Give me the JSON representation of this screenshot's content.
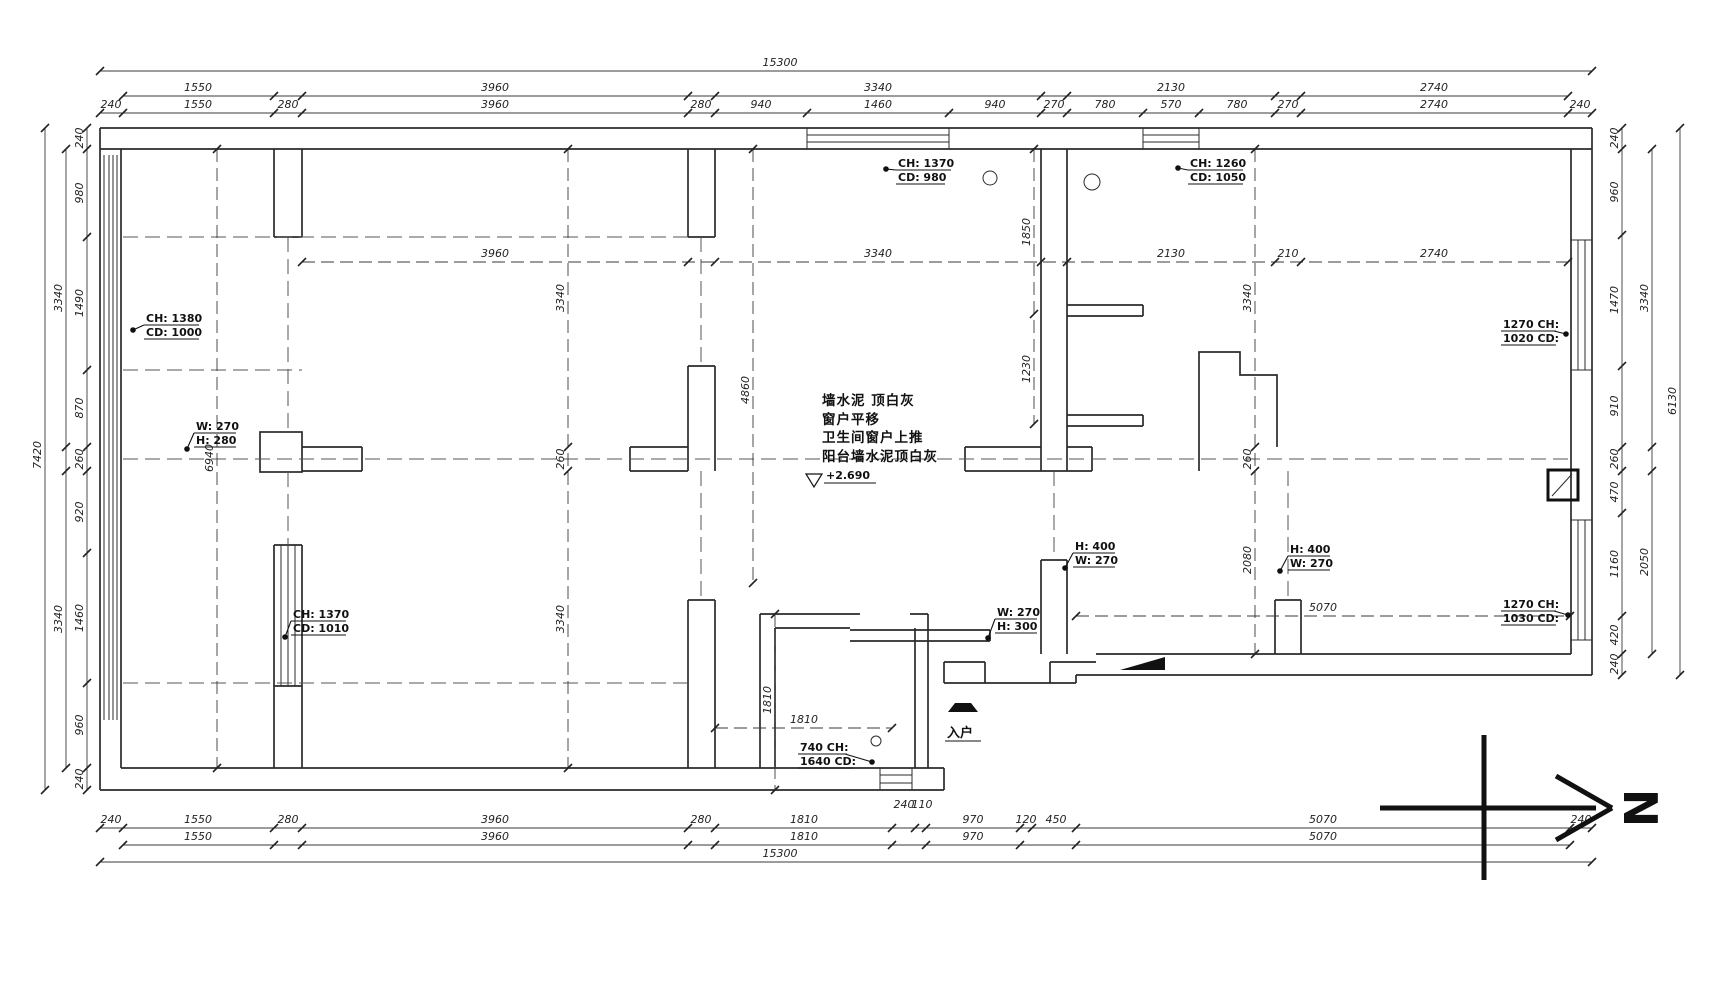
{
  "title": "floor-plan-drawing",
  "colors": {
    "line": "#2b2b2b",
    "dim": "#3a3a3a",
    "accent": "#111111"
  },
  "center_note": {
    "l1": "墙水泥 顶白灰",
    "l2": "窗户平移",
    "l3": "卫生间窗户上推",
    "l4": "阳台墙水泥顶白灰",
    "level": "+2.690"
  },
  "entrance_label": "入户",
  "north_label": "N",
  "leaders": [
    {
      "lines": [
        "CH: 1370",
        "CD: 980"
      ],
      "x": 898,
      "y": 157,
      "dot": [
        886,
        169
      ]
    },
    {
      "lines": [
        "CH: 1260",
        "CD: 1050"
      ],
      "x": 1190,
      "y": 157,
      "dot": [
        1178,
        168
      ]
    },
    {
      "lines": [
        "CH: 1380",
        "CD: 1000"
      ],
      "x": 146,
      "y": 312,
      "dot": [
        133,
        330
      ]
    },
    {
      "lines": [
        "W: 270",
        "H: 280"
      ],
      "x": 196,
      "y": 420,
      "dot": [
        187,
        449
      ]
    },
    {
      "lines": [
        "CH: 1370",
        "CD: 1010"
      ],
      "x": 293,
      "y": 608,
      "dot": [
        285,
        637
      ]
    },
    {
      "lines": [
        "H: 400",
        "W: 270"
      ],
      "x": 1075,
      "y": 540,
      "dot": [
        1065,
        568
      ]
    },
    {
      "lines": [
        "H: 400",
        "W: 270"
      ],
      "x": 1290,
      "y": 543,
      "dot": [
        1280,
        571
      ]
    },
    {
      "lines": [
        "W: 270",
        "H: 300"
      ],
      "x": 997,
      "y": 606,
      "dot": [
        988,
        638
      ]
    },
    {
      "lines": [
        "1270 CH:",
        "1020 CD:"
      ],
      "x": 1503,
      "y": 318,
      "dot": [
        1566,
        334
      ]
    },
    {
      "lines": [
        "1270 CH:",
        "1030 CD:"
      ],
      "x": 1503,
      "y": 598,
      "dot": [
        1568,
        615
      ]
    },
    {
      "lines": [
        "740 CH:",
        "1640 CD:"
      ],
      "x": 800,
      "y": 741,
      "dot": [
        872,
        762
      ]
    }
  ],
  "dim_strips": [
    {
      "name": "top-overall",
      "o": "h",
      "c": 71,
      "a": 100,
      "b": 1592,
      "ticks": [
        100,
        1592
      ],
      "labels": [
        {
          "t": "15300",
          "p": 780
        }
      ]
    },
    {
      "name": "top-sub",
      "o": "h",
      "c": 96,
      "a": 123,
      "b": 1568,
      "ticks": [
        123,
        274,
        302,
        688,
        715,
        1041,
        1067,
        1275,
        1301,
        1568
      ],
      "labels": [
        {
          "t": "1550",
          "p": 198
        },
        {
          "t": "3960",
          "p": 495
        },
        {
          "t": "3340",
          "p": 878
        },
        {
          "t": "2130",
          "p": 1171
        },
        {
          "t": "2740",
          "p": 1434
        }
      ]
    },
    {
      "name": "top-detail",
      "o": "h",
      "c": 113,
      "a": 100,
      "b": 1592,
      "ticks": [
        100,
        123,
        274,
        302,
        688,
        715,
        807,
        949,
        1041,
        1067,
        1143,
        1199,
        1275,
        1301,
        1568,
        1592
      ],
      "labels": [
        {
          "t": "240",
          "p": 111
        },
        {
          "t": "1550",
          "p": 198
        },
        {
          "t": "280",
          "p": 288
        },
        {
          "t": "3960",
          "p": 495
        },
        {
          "t": "280",
          "p": 701
        },
        {
          "t": "940",
          "p": 761
        },
        {
          "t": "1460",
          "p": 878
        },
        {
          "t": "940",
          "p": 995
        },
        {
          "t": "270",
          "p": 1054
        },
        {
          "t": "780",
          "p": 1105
        },
        {
          "t": "570",
          "p": 1171
        },
        {
          "t": "780",
          "p": 1237
        },
        {
          "t": "270",
          "p": 1288
        },
        {
          "t": "2740",
          "p": 1434
        },
        {
          "t": "240",
          "p": 1580
        }
      ]
    },
    {
      "name": "bottom-detail",
      "o": "h",
      "c": 828,
      "a": 100,
      "b": 1592,
      "ticks": [
        100,
        123,
        274,
        302,
        688,
        715,
        892,
        915,
        926,
        1020,
        1032,
        1076,
        1570,
        1592
      ],
      "labels": [
        {
          "t": "240",
          "p": 111
        },
        {
          "t": "1550",
          "p": 198
        },
        {
          "t": "280",
          "p": 288
        },
        {
          "t": "3960",
          "p": 495
        },
        {
          "t": "280",
          "p": 701
        },
        {
          "t": "1810",
          "p": 804
        },
        {
          "t": "240",
          "p": 904,
          "off": -20
        },
        {
          "t": "110",
          "p": 922,
          "off": -20
        },
        {
          "t": "970",
          "p": 973
        },
        {
          "t": "120",
          "p": 1026
        },
        {
          "t": "450",
          "p": 1056
        },
        {
          "t": "5070",
          "p": 1323
        },
        {
          "t": "240",
          "p": 1581
        }
      ]
    },
    {
      "name": "bottom-sub",
      "o": "h",
      "c": 845,
      "a": 123,
      "b": 1570,
      "ticks": [
        123,
        274,
        302,
        688,
        715,
        892,
        926,
        1020,
        1076,
        1570
      ],
      "labels": [
        {
          "t": "1550",
          "p": 198
        },
        {
          "t": "3960",
          "p": 495
        },
        {
          "t": "1810",
          "p": 804
        },
        {
          "t": "970",
          "p": 973
        },
        {
          "t": "5070",
          "p": 1323
        }
      ]
    },
    {
      "name": "bottom-overall",
      "o": "h",
      "c": 862,
      "a": 100,
      "b": 1592,
      "ticks": [
        100,
        1592
      ],
      "labels": [
        {
          "t": "15300",
          "p": 780
        }
      ]
    },
    {
      "name": "left-outer",
      "o": "v",
      "c": 45,
      "a": 128,
      "b": 790,
      "ticks": [
        128,
        790
      ],
      "labels": [
        {
          "t": "7420",
          "p": 455
        }
      ]
    },
    {
      "name": "left-mid",
      "o": "v",
      "c": 66,
      "a": 149,
      "b": 768,
      "ticks": [
        149,
        447,
        471,
        768
      ],
      "labels": [
        {
          "t": "3340",
          "p": 298
        },
        {
          "t": "3340",
          "p": 619
        }
      ]
    },
    {
      "name": "left-inner",
      "o": "v",
      "c": 87,
      "a": 128,
      "b": 790,
      "ticks": [
        128,
        149,
        237,
        370,
        447,
        471,
        553,
        683,
        768,
        790
      ],
      "labels": [
        {
          "t": "240",
          "p": 138
        },
        {
          "t": "980",
          "p": 193
        },
        {
          "t": "1490",
          "p": 303
        },
        {
          "t": "870",
          "p": 408
        },
        {
          "t": "260",
          "p": 459
        },
        {
          "t": "920",
          "p": 512
        },
        {
          "t": "1460",
          "p": 618
        },
        {
          "t": "960",
          "p": 725
        },
        {
          "t": "240",
          "p": 779
        }
      ]
    },
    {
      "name": "right-inner",
      "o": "v",
      "c": 1622,
      "a": 128,
      "b": 675,
      "ticks": [
        128,
        149,
        235,
        366,
        447,
        471,
        513,
        616,
        654,
        675
      ],
      "labels": [
        {
          "t": "240",
          "p": 138
        },
        {
          "t": "960",
          "p": 192
        },
        {
          "t": "1470",
          "p": 300
        },
        {
          "t": "910",
          "p": 406
        },
        {
          "t": "260",
          "p": 459
        },
        {
          "t": "470",
          "p": 492
        },
        {
          "t": "1160",
          "p": 564
        },
        {
          "t": "420",
          "p": 635
        },
        {
          "t": "240",
          "p": 664
        }
      ]
    },
    {
      "name": "right-mid",
      "o": "v",
      "c": 1652,
      "a": 149,
      "b": 654,
      "ticks": [
        149,
        447,
        471,
        654
      ],
      "labels": [
        {
          "t": "3340",
          "p": 298
        },
        {
          "t": "2050",
          "p": 562
        }
      ]
    },
    {
      "name": "right-outer",
      "o": "v",
      "c": 1680,
      "a": 128,
      "b": 675,
      "ticks": [
        128,
        675
      ],
      "labels": [
        {
          "t": "6130",
          "p": 401
        }
      ]
    },
    {
      "name": "int-upper-row",
      "o": "h",
      "c": 262,
      "a": 302,
      "b": 1568,
      "dashed": true,
      "ticks": [
        302,
        688,
        715,
        1041,
        1067,
        1275,
        1301,
        1568
      ],
      "labels": [
        {
          "t": "3960",
          "p": 495
        },
        {
          "t": "3340",
          "p": 878
        },
        {
          "t": "2130",
          "p": 1171
        },
        {
          "t": "210",
          "p": 1288
        },
        {
          "t": "2740",
          "p": 1434
        }
      ]
    },
    {
      "name": "int-5070",
      "o": "h",
      "c": 616,
      "a": 1076,
      "b": 1570,
      "dashed": true,
      "ticks": [
        1076,
        1570
      ],
      "labels": [
        {
          "t": "5070",
          "p": 1323
        }
      ]
    },
    {
      "name": "int-1810-h",
      "o": "h",
      "c": 728,
      "a": 715,
      "b": 892,
      "dashed": true,
      "ticks": [
        715,
        892
      ],
      "labels": [
        {
          "t": "1810",
          "p": 804
        }
      ]
    },
    {
      "name": "int-v-left",
      "o": "v",
      "c": 217,
      "a": 149,
      "b": 768,
      "dashed": true,
      "ticks": [
        149,
        768
      ],
      "labels": [
        {
          "t": "6940",
          "p": 458
        }
      ]
    },
    {
      "name": "int-v-3340",
      "o": "v",
      "c": 568,
      "a": 149,
      "b": 768,
      "dashed": true,
      "ticks": [
        149,
        447,
        471,
        768
      ],
      "labels": [
        {
          "t": "3340",
          "p": 298
        },
        {
          "t": "260",
          "p": 459
        },
        {
          "t": "3340",
          "p": 619
        }
      ]
    },
    {
      "name": "int-v-4860",
      "o": "v",
      "c": 753,
      "a": 149,
      "b": 583,
      "dashed": true,
      "ticks": [
        149,
        583
      ],
      "labels": [
        {
          "t": "4860",
          "p": 390
        }
      ]
    },
    {
      "name": "int-v-bath",
      "o": "v",
      "c": 1034,
      "a": 149,
      "b": 424,
      "dashed": true,
      "ticks": [
        149,
        314,
        424
      ],
      "labels": [
        {
          "t": "1850",
          "p": 232
        },
        {
          "t": "1230",
          "p": 369
        }
      ]
    },
    {
      "name": "int-v-right",
      "o": "v",
      "c": 1255,
      "a": 149,
      "b": 654,
      "dashed": true,
      "ticks": [
        149,
        447,
        471,
        654
      ],
      "labels": [
        {
          "t": "3340",
          "p": 298
        },
        {
          "t": "260",
          "p": 459
        },
        {
          "t": "2080",
          "p": 560
        }
      ]
    },
    {
      "name": "int-v-1810",
      "o": "v",
      "c": 775,
      "a": 614,
      "b": 790,
      "dashed": true,
      "ticks": [
        614,
        790
      ],
      "labels": [
        {
          "t": "1810",
          "p": 700
        }
      ]
    }
  ]
}
